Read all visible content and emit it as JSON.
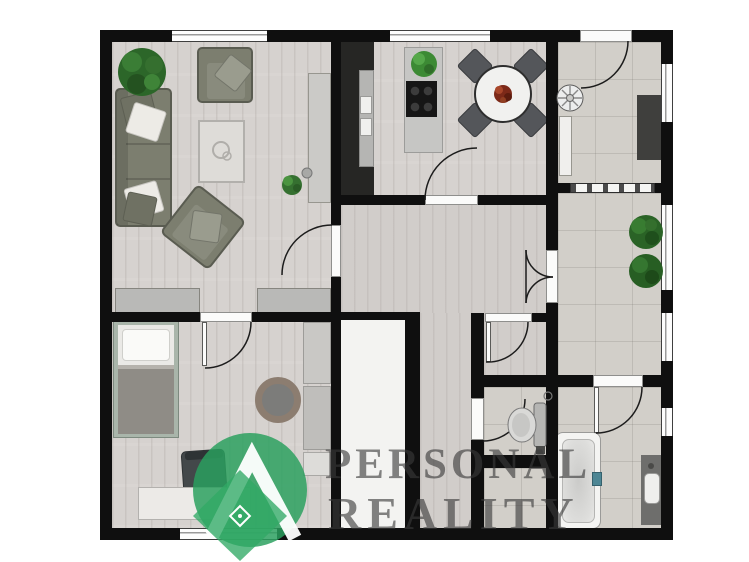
{
  "watermark": {
    "line1": "PERSONAL",
    "line2": "REALITY"
  },
  "colors": {
    "wall": "#0f0f0f",
    "wood": "#d6d2cf",
    "wood_dark": "#d1cdca",
    "tile": "#d2cfc9",
    "white_floor": "#f3f3f1",
    "sofa": "#7c7e6f",
    "sofa_border": "#5a5c51",
    "pillow_white": "#edebe6",
    "pillow_olive": "#6f7163",
    "bed_frame": "#a9b5aa",
    "mattress": "#eae9e6",
    "blanket": "#8f8c86",
    "counter_dark": "#262624",
    "counter_inner": "#b5b5b3",
    "island": "#c6c6c4",
    "cooktop": "#161616",
    "table_top": "#f1f1ef",
    "chair": "#54565a",
    "chair_desk": "#43484a",
    "sideboard": "#cbcac7",
    "chest": "#b9b9b7",
    "wardrobe": "#c9c8c5",
    "dark_mat": "#3f3f3d",
    "vanity": "#6e6e6c",
    "tub_teal": "#4d8694",
    "rug_ring": "#8c7d70",
    "rug_center": "#7c7c7a",
    "plant": "#2c6629",
    "logo_green": "#2aa05e",
    "logo_green_light": "#31a965",
    "watermark_text": "#3a3a3a"
  }
}
